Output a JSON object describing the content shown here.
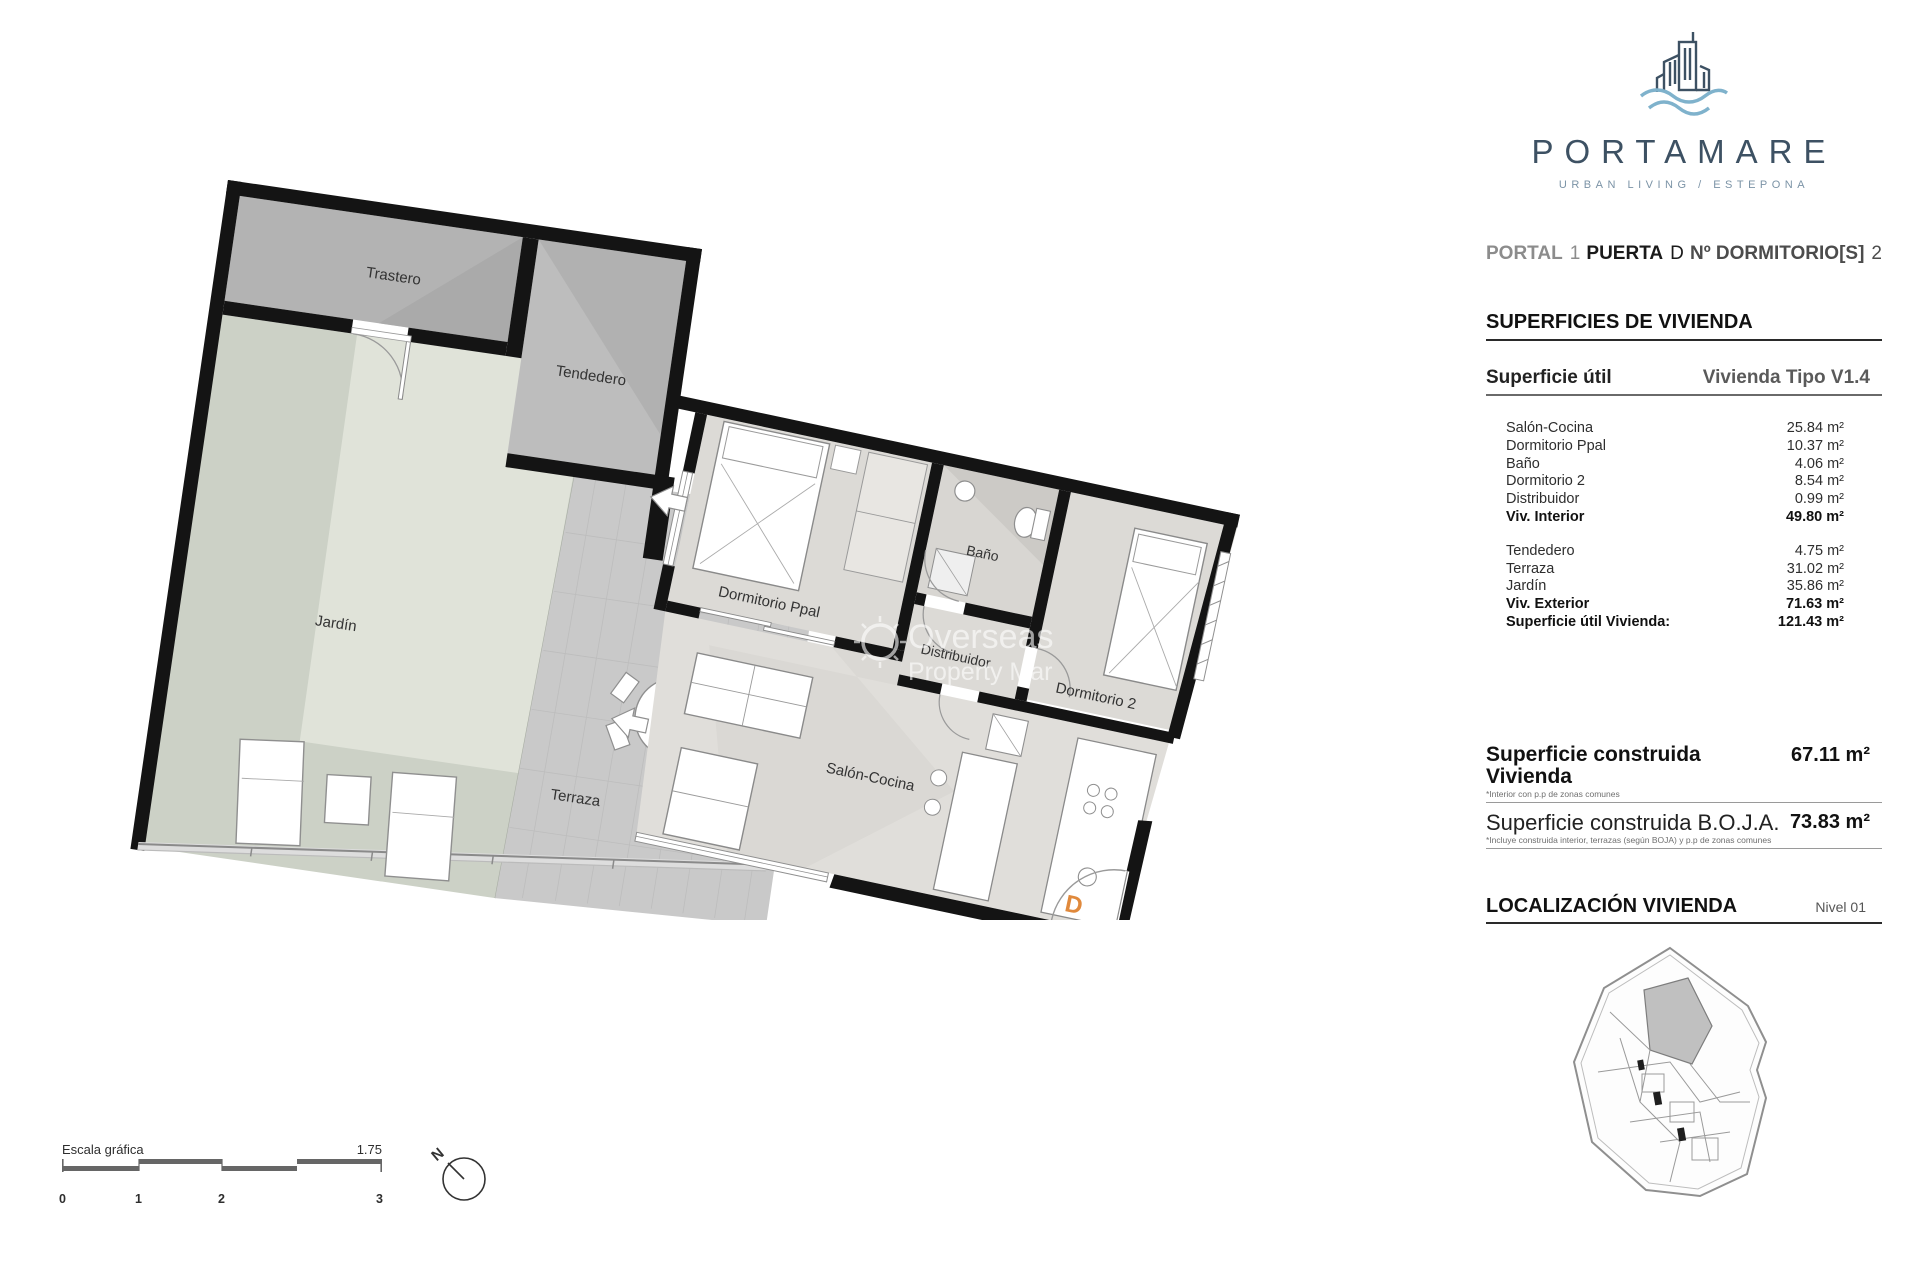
{
  "logo": {
    "name": "PORTAMARE",
    "tagline": "URBAN LIVING / ESTEPONA"
  },
  "header": {
    "portal_label": "PORTAL",
    "portal_value": "1",
    "puerta_label": "PUERTA",
    "puerta_value": "D",
    "dormitorios_label": "Nº DORMITORIO[S]",
    "dormitorios_value": "2"
  },
  "surfaces": {
    "title": "SUPERFICIES DE VIVIENDA",
    "subtitle_left": "Superficie útil",
    "subtitle_right": "Vivienda Tipo V1.4",
    "rows": [
      {
        "label": "Salón-Cocina",
        "value": "25.84 m²"
      },
      {
        "label": "Dormitorio Ppal",
        "value": "10.37 m²"
      },
      {
        "label": "Baño",
        "value": "4.06 m²"
      },
      {
        "label": "Dormitorio 2",
        "value": "8.54 m²"
      },
      {
        "label": "Distribuidor",
        "value": "0.99 m²"
      },
      {
        "label": "Viv. Interior",
        "value": "49.80 m²"
      },
      {
        "label": "Tendedero",
        "value": "4.75 m²"
      },
      {
        "label": "Terraza",
        "value": "31.02 m²"
      },
      {
        "label": "Jardín",
        "value": "35.86 m²"
      },
      {
        "label": "Viv. Exterior",
        "value": "71.63 m²"
      },
      {
        "label": "Superficie útil Vivienda:",
        "value": "121.43 m²"
      }
    ]
  },
  "built": {
    "row1_label": "Superficie construida Vivienda",
    "row1_note": "*Interior con p.p de zonas comunes",
    "row1_value": "67.11 m²",
    "row2_label": "Superficie construida B.O.J.A.",
    "row2_note": "*Incluye construida interior, terrazas (según BOJA) y p.p de zonas comunes",
    "row2_value": "73.83 m²"
  },
  "location": {
    "title": "LOCALIZACIÓN VIVIENDA",
    "level": "Nivel 01"
  },
  "plan": {
    "rooms": {
      "trastero": "Trastero",
      "tendedero": "Tendedero",
      "jardin": "Jardín",
      "terraza": "Terraza",
      "dorm_ppal": "Dormitorio Ppal",
      "bano": "Baño",
      "distribuidor": "Distribuidor",
      "dorm2": "Dormitorio 2",
      "salon": "Salón-Cocina"
    },
    "door_letter": "D"
  },
  "scalebar": {
    "label": "Escala gráfica",
    "ratio": "1.75",
    "ticks": [
      "0",
      "1",
      "2",
      "3"
    ]
  },
  "north": {
    "label": "N"
  },
  "watermark": {
    "line1": "Overseas",
    "line2": "Property Mar"
  },
  "colors": {
    "logo_blue": "#3d5163",
    "wave_blue": "#7fb2cc",
    "door_letter_orange": "#e0893c",
    "garden_green": "#ccd1c6",
    "terrace_gray": "#c9c9c9",
    "wall_black": "#141414"
  }
}
